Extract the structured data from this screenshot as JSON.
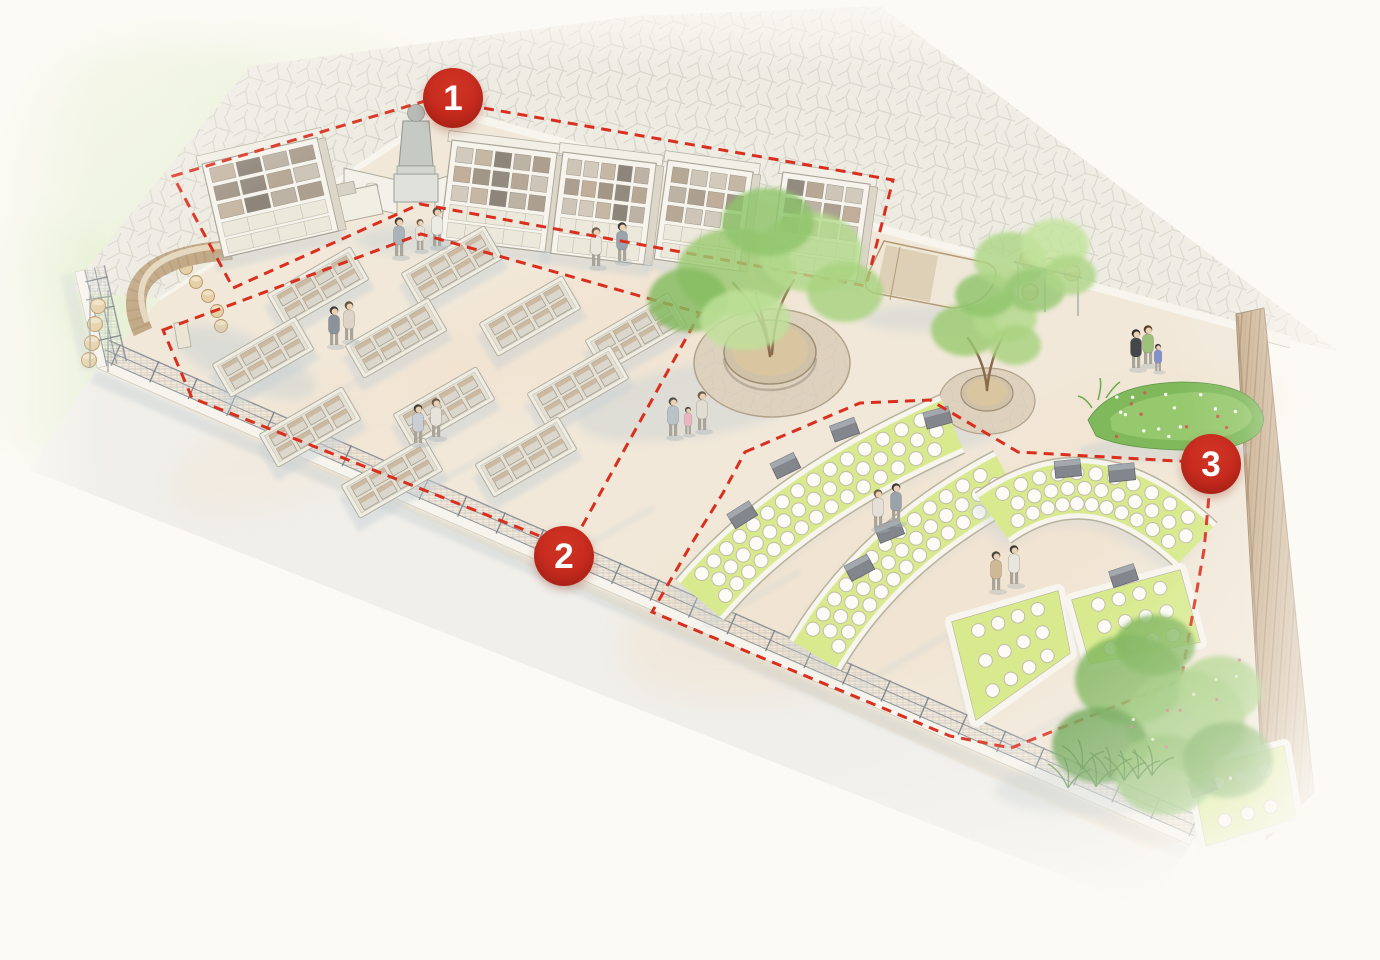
{
  "markers": [
    {
      "id": "zone-1",
      "label": "1"
    },
    {
      "id": "zone-2",
      "label": "2"
    },
    {
      "id": "zone-3",
      "label": "3"
    }
  ],
  "colors": {
    "marker_red": "#c2271b",
    "dash_red": "#da2f1e",
    "lawn_green": "#d8ea8d",
    "plaza_beige": "#f1e8d9",
    "paving_gray": "#edebe2",
    "tree_green": "#9ccb72",
    "wood_fence_tan": "#c9ae8d",
    "background_cream": "#fcfaf5"
  }
}
